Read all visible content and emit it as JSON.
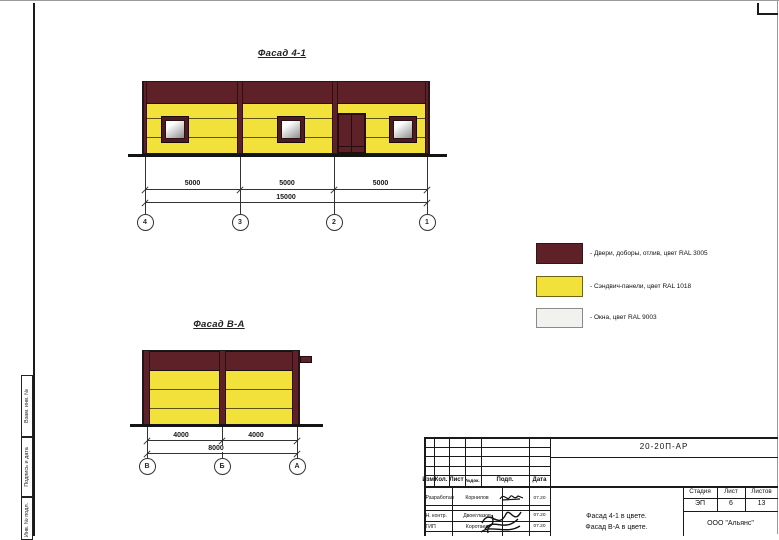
{
  "colors": {
    "ral3005": "#5e2127",
    "ral1018": "#f2e13b",
    "ral9003": "#f1f1ee"
  },
  "facade1": {
    "title": "Фасад 4-1",
    "dims": [
      "5000",
      "5000",
      "5000"
    ],
    "total": "15000",
    "axes": [
      "4",
      "3",
      "2",
      "1"
    ]
  },
  "facade2": {
    "title": "Фасад В-А",
    "dims": [
      "4000",
      "4000"
    ],
    "total": "8000",
    "axes": [
      "В",
      "Б",
      "А"
    ]
  },
  "legend": {
    "items": [
      {
        "label": "- Двери, доборы, отлив, цвет RAL 3005",
        "color": "#5e2127"
      },
      {
        "label": "- Сэндвич-панели, цвет RAL 1018",
        "color": "#f2e13b"
      },
      {
        "label": "- Окна, цвет RAL 9003",
        "color": "#f1f1ee"
      }
    ]
  },
  "sidebar": {
    "labels": [
      "Взам. инв. №",
      "Подпись и дата",
      "Инв. № подл."
    ]
  },
  "titleblock": {
    "doc_number": "20-20П-АР",
    "header_cols": [
      "Изм.",
      "Кол.",
      "Лист",
      "№док.",
      "Подп.",
      "Дата"
    ],
    "rows": [
      {
        "role": "Разработал",
        "name": "Корнилов",
        "date": "07.20"
      },
      {
        "role": "Н. контр.",
        "name": "Двоеглазов",
        "date": "07.20"
      },
      {
        "role": "ГИП",
        "name": "Коротаев",
        "date": "07.20"
      }
    ],
    "sheet_title_line1": "Фасад 4-1 в цвете.",
    "sheet_title_line2": "Фасад В-А в цвете.",
    "stage_header": [
      "Стадия",
      "Лист",
      "Листов"
    ],
    "stage_values": [
      "ЭП",
      "6",
      "13"
    ],
    "company": "ООО \"Альянс\""
  }
}
